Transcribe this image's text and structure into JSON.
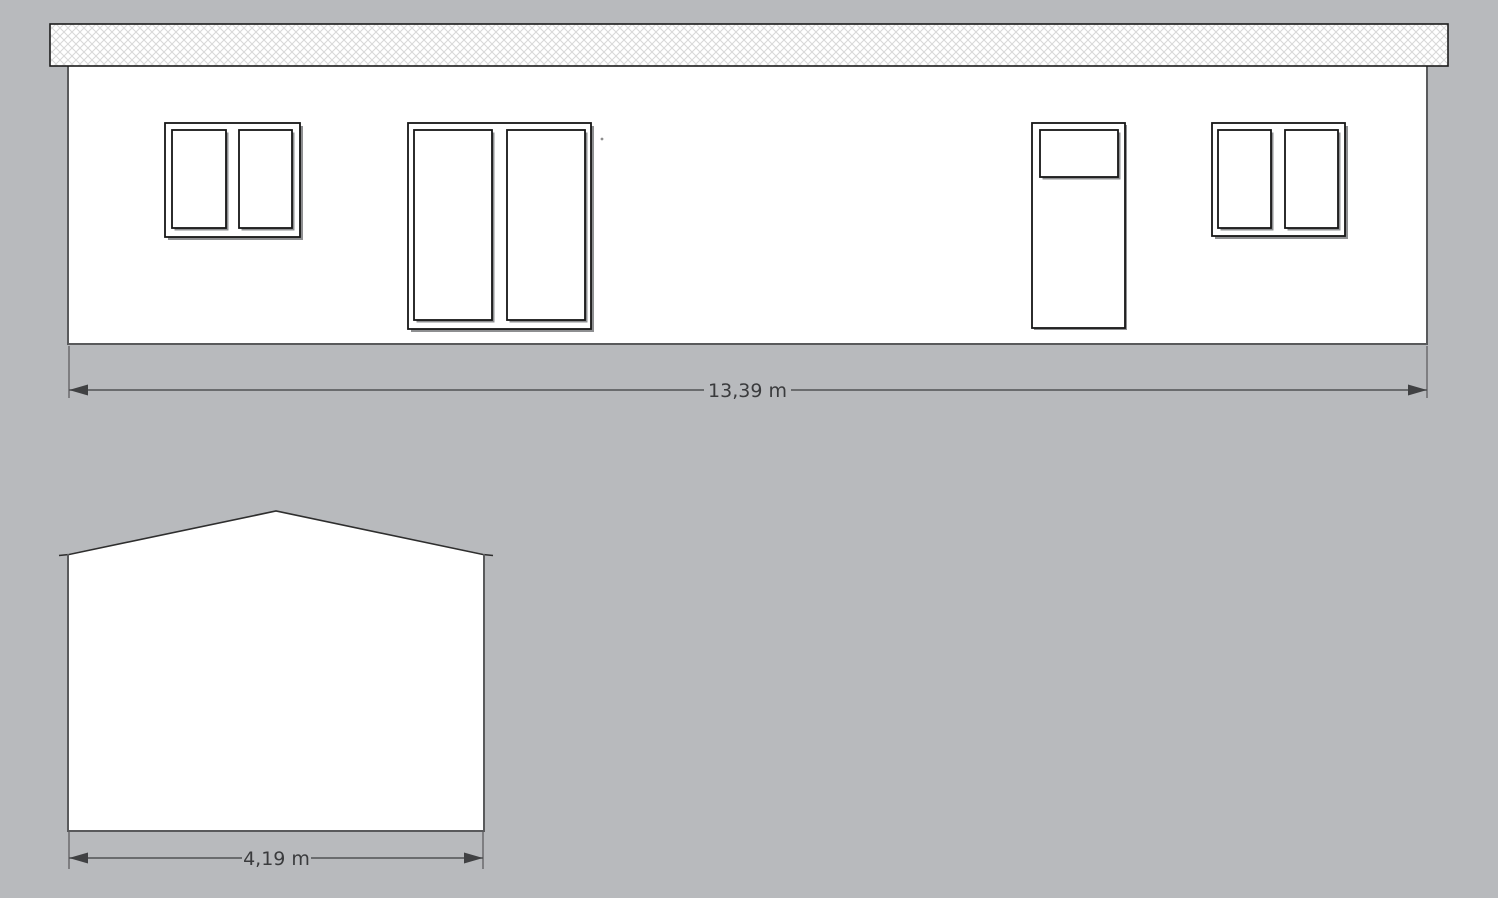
{
  "drawing": {
    "type": "architectural-elevation",
    "front_elevation": {
      "width_dimension": {
        "label": "13,39 m"
      },
      "features": {
        "roof_band": "crosshatched-fascia",
        "left_window": "two-pane-window",
        "large_window": "two-pane-french-window",
        "door": "door-with-top-light",
        "right_window": "two-pane-window"
      }
    },
    "side_elevation": {
      "width_dimension": {
        "label": "4,19 m"
      },
      "features": {
        "gable": "pitched-roof-gable-end"
      }
    },
    "colors": {
      "background": "#b8babd",
      "wall_fill": "#ffffff",
      "wall_outline": "#595a5c",
      "frame_outline": "#161616",
      "frame_shadow": "#8e8f91",
      "hatch_line": "#d7d7d7",
      "roof_outline": "#1c1c1c",
      "dimension_line": "#515254",
      "dimension_arrow": "#404143",
      "dimension_text": "#3a3b3d"
    },
    "icons": {
      "left_arrow": "dimension-arrow-left-icon",
      "right_arrow": "dimension-arrow-right-icon"
    }
  }
}
